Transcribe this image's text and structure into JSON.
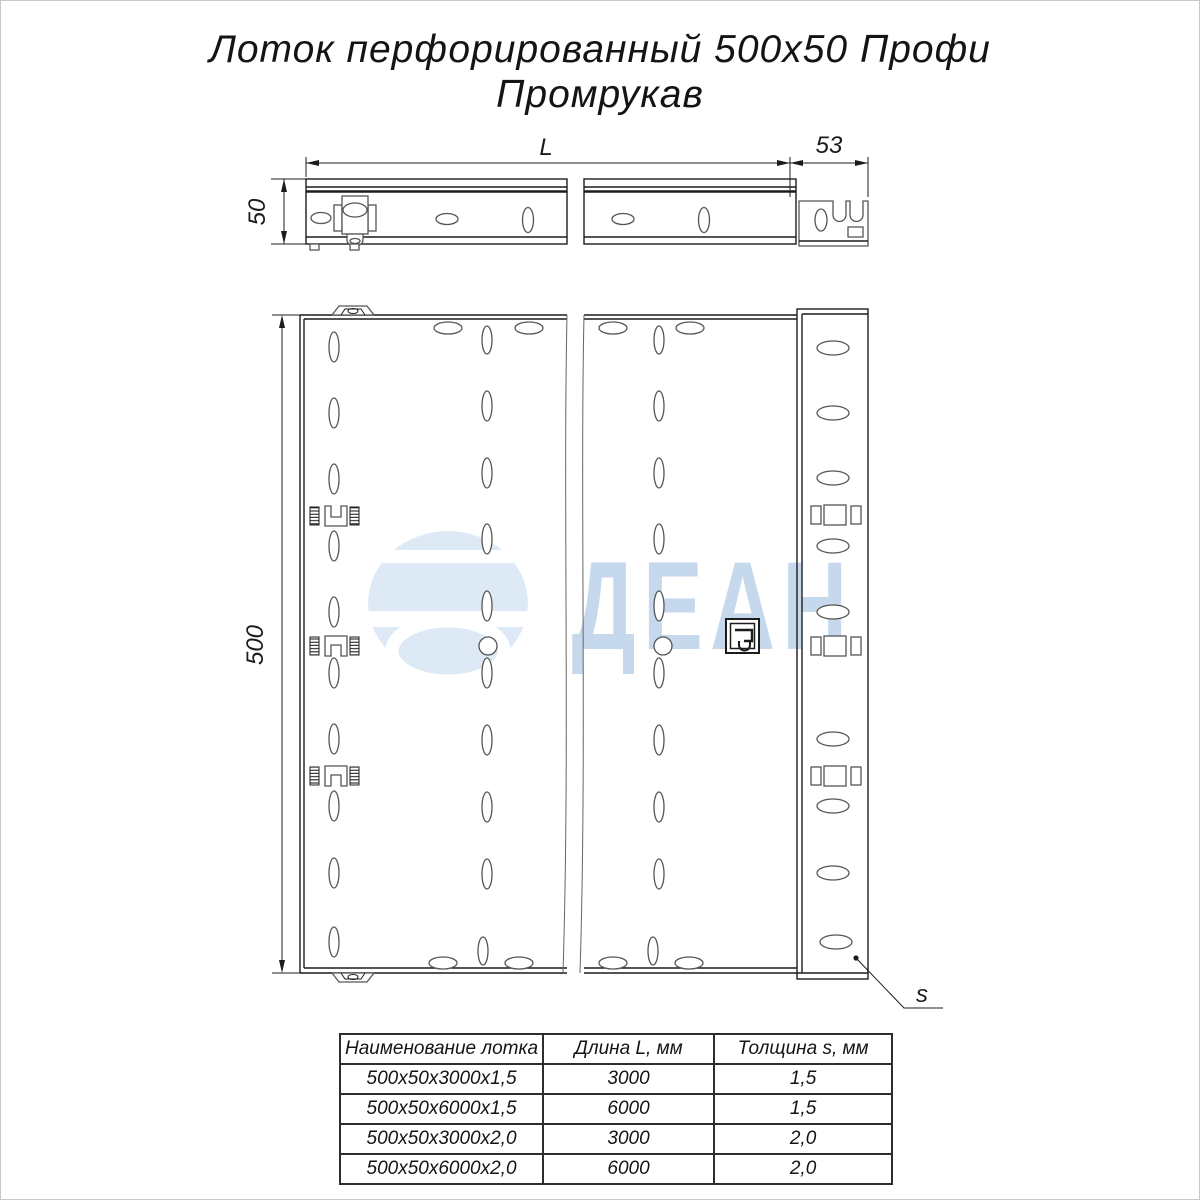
{
  "title": {
    "line1": "Лоток перфорированный 500х50 Профи",
    "line2": "Промрукав"
  },
  "dimensions": {
    "length": "L",
    "end_section_width": "53",
    "side_height": "50",
    "tray_width": "500",
    "thickness": "s"
  },
  "watermark": {
    "text": "ДЕАН"
  },
  "colors": {
    "ink": "#1c1c1c",
    "wm-globe": "#dde9f5",
    "wm-text": "#c5d8ec"
  },
  "table": {
    "headers": [
      "Наименование лотка",
      "Длина L, мм",
      "Толщина s, мм"
    ],
    "rows": [
      {
        "name": "500х50х3000х1,5",
        "length": "3000",
        "thickness": "1,5"
      },
      {
        "name": "500х50х6000х1,5",
        "length": "6000",
        "thickness": "1,5"
      },
      {
        "name": "500х50х3000х2,0",
        "length": "3000",
        "thickness": "2,0"
      },
      {
        "name": "500х50х6000х2,0",
        "length": "6000",
        "thickness": "2,0"
      }
    ]
  }
}
